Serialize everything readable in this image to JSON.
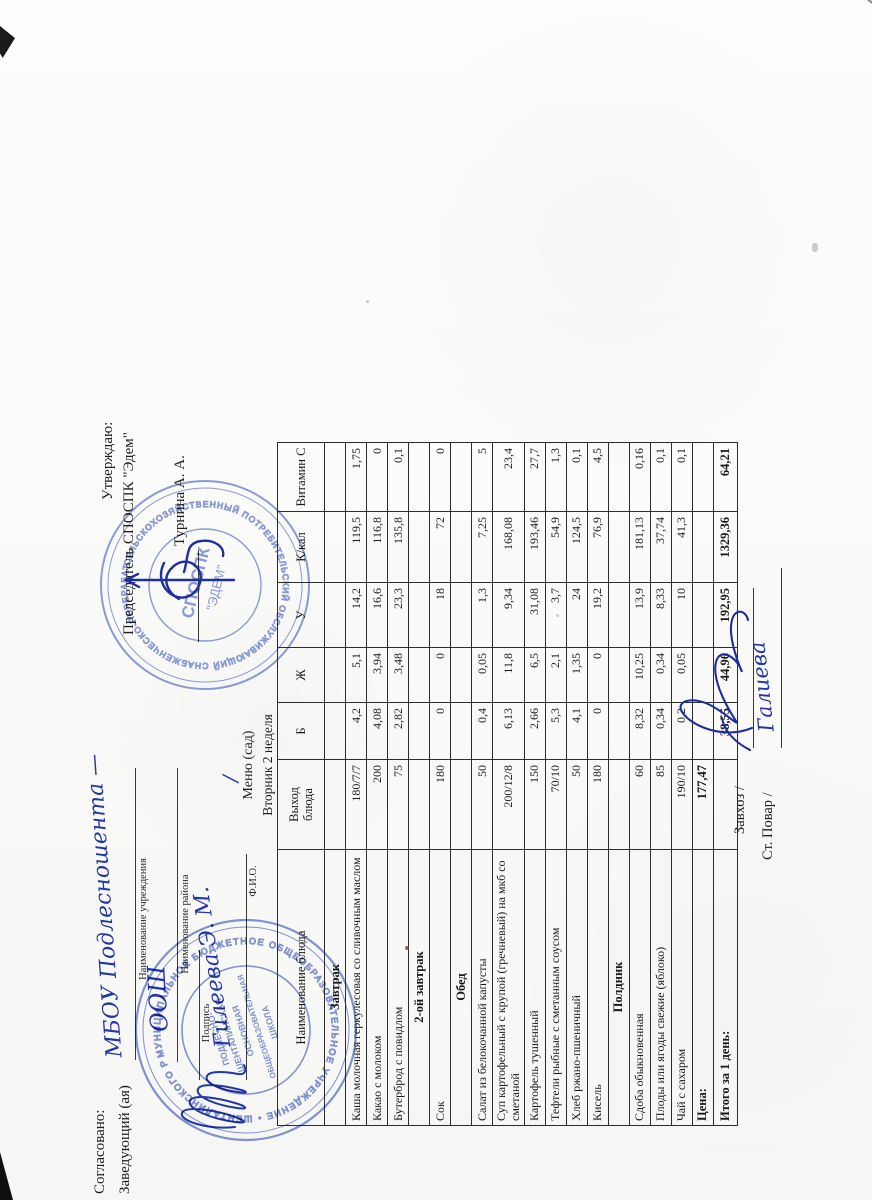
{
  "colors": {
    "ink": "#1f1f1f",
    "pen": "#1d2f9f",
    "stamp_blue": "#5f74c6"
  },
  "approval_left": {
    "title": "Согласовано:",
    "role_label": "Заведующий (ая)",
    "institution_handwritten": "МБОУ Подлесношента —",
    "institution_label": "Наименование учреждения",
    "district_handwritten": "ООШ",
    "district_label": "Наименование района",
    "signature_label": "Подпись",
    "fio_handwritten": "Гилеева Э. М.",
    "fio_label": "Ф.И.О.",
    "stray_slash": "/"
  },
  "approval_right": {
    "title": "Утверждаю:",
    "role_line": "Председатель СПОСПК \"Эдем\"",
    "approver_name": "Турнина А. А."
  },
  "menu_header": {
    "title": "Меню (сад)",
    "subtitle": "Вторник 2 неделя"
  },
  "stamps": {
    "left": {
      "ring_text": "МУНИЦИПАЛЬНОЕ БЮДЖЕТНОЕ ОБЩЕОБРАЗОВАТЕЛЬНОЕ УЧРЕЖДЕНИЕ • ШЕНТАЛИНСКОГО РАЙОНА РЕСПУБЛИКИ ТАТАРСТАН •",
      "center_lines": [
        "ПОДЛЕСНО-",
        "ШЕНТАЛИНСКАЯ",
        "ОСНОВНАЯ",
        "ОБЩЕОБРАЗОВАТЕЛЬНАЯ",
        "ШКОЛА"
      ]
    },
    "right": {
      "ring_text": "СЕЛЬСКОХОЗЯЙСТВЕННЫЙ ПОТРЕБИТЕЛЬСКИЙ ОБСЛУЖИВАЮЩИЙ СНАБЖЕНЧЕСКО-ПЕРЕРАБАТЫВАЮЩИЙ КООПЕРАТИВ",
      "center_line1": "СПОСПК",
      "center_line2": "\"ЭДЕМ\""
    }
  },
  "table": {
    "columns": [
      "Наименование блюда",
      "Выход\nблюда",
      "Б",
      "Ж",
      "У",
      "К/кал",
      "Витамин С"
    ],
    "rows": [
      {
        "type": "section",
        "name": "Завтрак",
        "values": [
          "",
          "",
          "",
          "",
          "",
          ""
        ]
      },
      {
        "type": "dish",
        "name": "Каша молочная геркулесовая со сливочным маслом",
        "values": [
          "180/7/7",
          "4,2",
          "5,1",
          "14,2",
          "119,5",
          "1,75"
        ]
      },
      {
        "type": "dish",
        "name": "Какао с молоком",
        "values": [
          "200",
          "4,08",
          "3,94",
          "16,6",
          "116,8",
          "0"
        ]
      },
      {
        "type": "dish",
        "name": "Бутерброд с повидлом",
        "values": [
          "75",
          "2,82",
          "3,48",
          "23,3",
          "135,8",
          "0,1"
        ]
      },
      {
        "type": "section",
        "name": "2-ой завтрак",
        "values": [
          "",
          "",
          "",
          "",
          "",
          ""
        ]
      },
      {
        "type": "dish",
        "name": "Сок",
        "values": [
          "180",
          "0",
          "0",
          "18",
          "72",
          "0"
        ]
      },
      {
        "type": "section",
        "name": "Обед",
        "values": [
          "",
          "",
          "",
          "",
          "",
          ""
        ]
      },
      {
        "type": "dish",
        "name": "Салат из белокочанной капусты",
        "values": [
          "50",
          "0,4",
          "0,05",
          "1,3",
          "7,25",
          "5"
        ]
      },
      {
        "type": "dish",
        "wrap": true,
        "name": "Суп картофельный с крупой (гречневый) на мкб со сметаной",
        "values": [
          "200/12/8",
          "6,13",
          "11,8",
          "9,34",
          "168,08",
          "23,4"
        ]
      },
      {
        "type": "dish",
        "name": "Картофель тушенный",
        "values": [
          "150",
          "2,66",
          "6,5",
          "31,08",
          "193,46",
          "27,7"
        ]
      },
      {
        "type": "dish",
        "name": "Тефтели рыбные с сметанным соусом",
        "values": [
          "70/10",
          "5,3",
          "2,1",
          "3,7",
          "54,9",
          "1,3"
        ]
      },
      {
        "type": "dish",
        "name": "Хлеб ржано-пшеничный",
        "values": [
          "50",
          "4,1",
          "1,35",
          "24",
          "124,5",
          "0,1"
        ]
      },
      {
        "type": "dish",
        "name": "Кисель",
        "values": [
          "180",
          "0",
          "0",
          "19,2",
          "76,9",
          "4,5"
        ]
      },
      {
        "type": "section",
        "name": "Полдник",
        "values": [
          "",
          "",
          "",
          "",
          "",
          ""
        ]
      },
      {
        "type": "dish",
        "name": "Сдоба обыкновенная",
        "values": [
          "60",
          "8,32",
          "10,25",
          "13,9",
          "181,13",
          "0,16"
        ]
      },
      {
        "type": "dish",
        "name": "Плоды или ягоды свежие (яблоко)",
        "values": [
          "85",
          "0,34",
          "0,34",
          "8,33",
          "37,74",
          "0,1"
        ]
      },
      {
        "type": "dish",
        "name": "Чай с сахаром",
        "values": [
          "190/10",
          "0,2",
          "0,05",
          "10",
          "41,3",
          "0,1"
        ]
      },
      {
        "type": "price",
        "name": "Цена:",
        "values": [
          "177,47",
          "",
          "",
          "",
          "",
          ""
        ]
      },
      {
        "type": "total",
        "name": "Итого за 1 день:",
        "values": [
          "",
          "38,55",
          "44,96",
          "192,95",
          "1329,36",
          "64,21"
        ]
      }
    ]
  },
  "footer": {
    "zavhoz_label": "Завхоз /",
    "cook_label": "Ст. Повар /",
    "cook_signature_handwritten": "Галиева"
  }
}
